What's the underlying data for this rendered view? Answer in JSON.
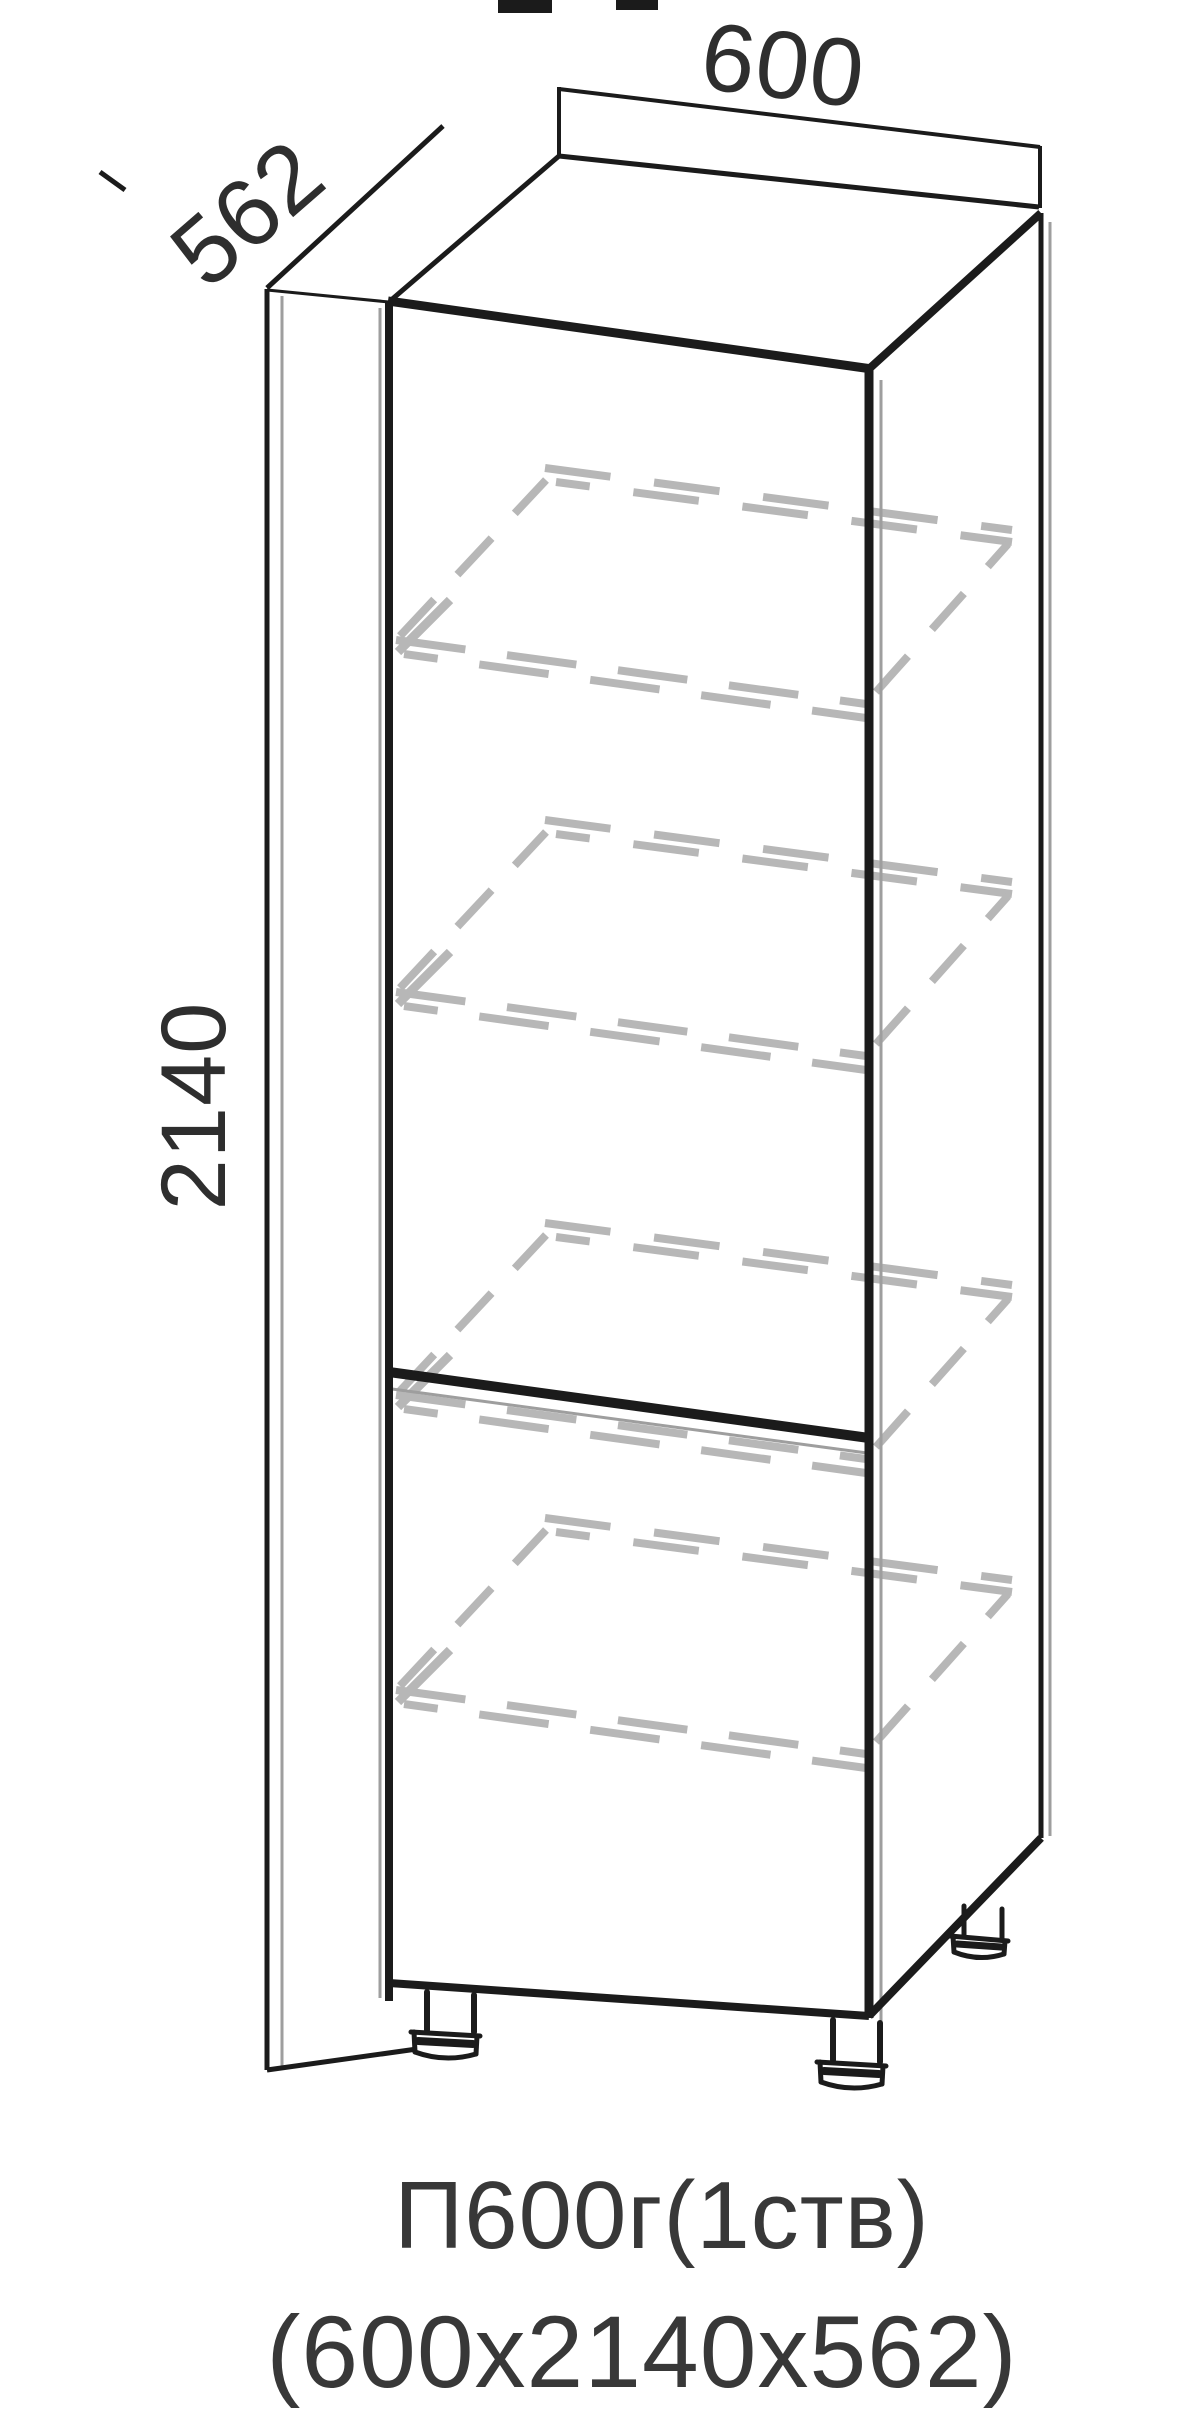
{
  "drawing": {
    "background": "#ffffff",
    "colors": {
      "line": "#1b1b1b",
      "shadow": "#9e9e9e",
      "hidden": "#b7b7b7",
      "text": "#2e2e2e"
    },
    "dimensions": {
      "width": "600",
      "depth": "562",
      "height": "2140"
    },
    "caption": {
      "model": "П600г(1ств)",
      "size": "(600х2140х562)"
    },
    "shelves": {
      "front_edge_y": [
        640,
        992,
        1395,
        1690
      ]
    }
  }
}
